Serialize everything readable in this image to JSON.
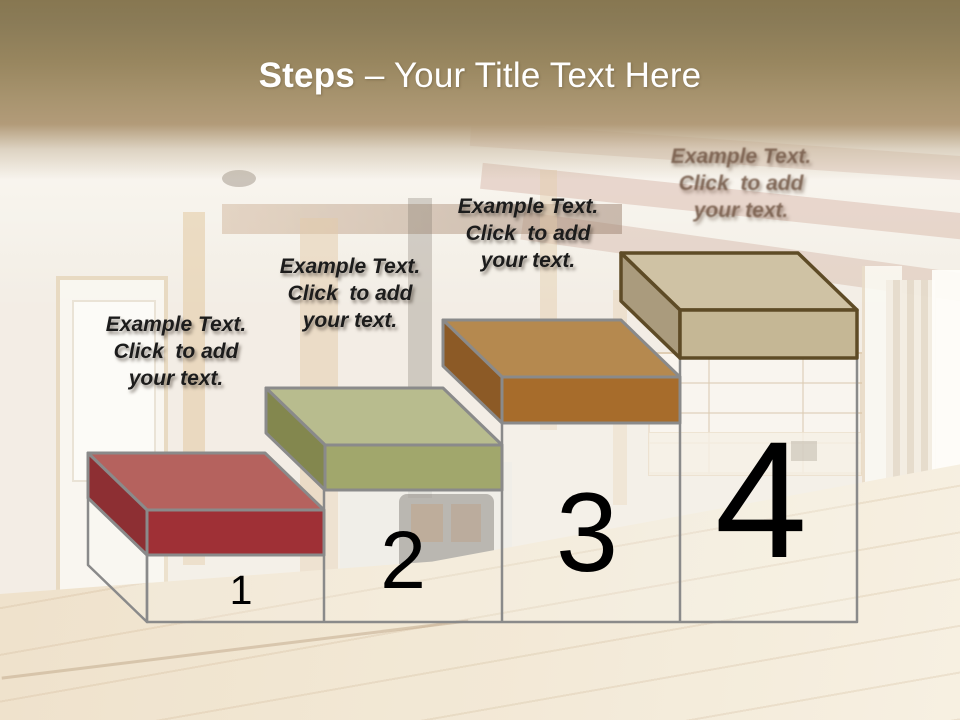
{
  "slide": {
    "title": {
      "bold": "Steps",
      "rest": "– Your Title Text Here"
    }
  },
  "palette": {
    "header_top": "#877751",
    "header_bottom": "#b29b79",
    "title_text": "#ffffff",
    "outline_gray": "#8a8a8a",
    "pedestal_fill": "rgba(250,250,248,0.22)",
    "number_color": "#000000",
    "label_color": "#1c1c1c"
  },
  "steps": [
    {
      "number": "1",
      "label_lines": [
        "Example Text.",
        "Click  to add",
        "your text."
      ],
      "colors": {
        "top": "#b5625e",
        "front": "#9f3036",
        "side": "#8d2f33",
        "outline": "#8a8a8a"
      }
    },
    {
      "number": "2",
      "label_lines": [
        "Example Text.",
        "Click  to add",
        "your text."
      ],
      "colors": {
        "top": "#b8bc8e",
        "front": "#a1a76c",
        "side": "#83874e",
        "outline": "#8a8a8a"
      }
    },
    {
      "number": "3",
      "label_lines": [
        "Example Text.",
        "Click  to add",
        "your text."
      ],
      "colors": {
        "top": "#b5894f",
        "front": "#a76c2b",
        "side": "#8c5a26",
        "outline": "#8a8a8a"
      }
    },
    {
      "number": "4",
      "label_lines": [
        "Example Text.",
        "Click  to add",
        "your text."
      ],
      "colors": {
        "top": "#cfc2a4",
        "front": "#c5b795",
        "side": "#aa9b7d",
        "outline": "#5e4b26"
      }
    }
  ]
}
